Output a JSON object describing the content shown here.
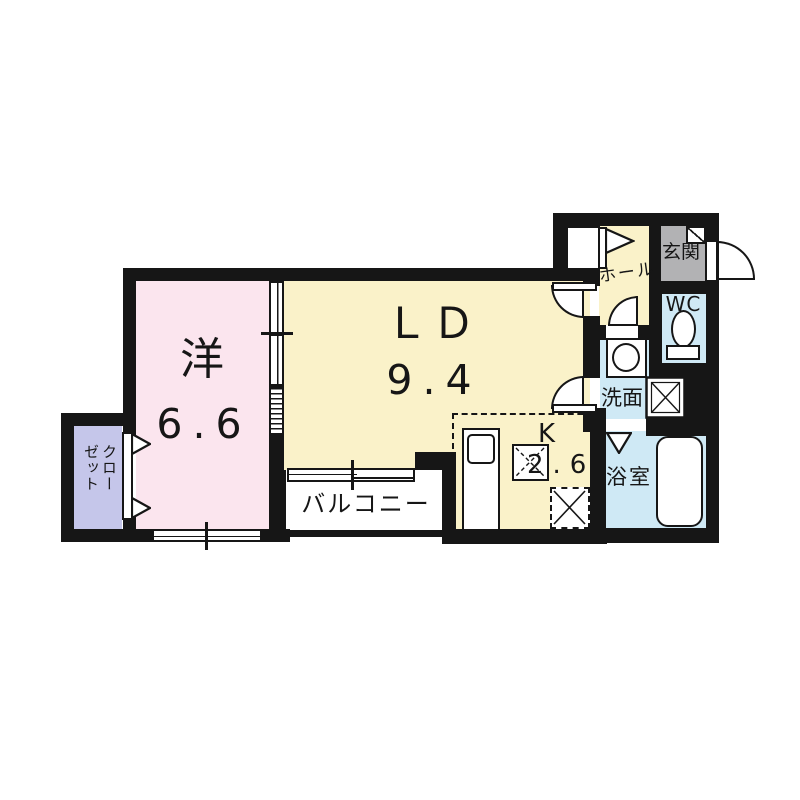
{
  "plan": {
    "type": "apartment-floorplan",
    "rooms": {
      "western": {
        "name": "洋",
        "area": "6.6"
      },
      "living_dining": {
        "name": "ＬＤ",
        "area": "9.4"
      },
      "kitchen": {
        "name": "K",
        "area": "2.6"
      },
      "balcony": {
        "name": "バルコニー"
      },
      "closet": {
        "name": "クローゼット"
      },
      "hall": {
        "name": "ホール"
      },
      "entrance": {
        "name": "玄関"
      },
      "toilet": {
        "name": "WC"
      },
      "washroom": {
        "name": "洗面"
      },
      "bathroom": {
        "name": "浴室"
      }
    },
    "colors": {
      "wall": "#161616",
      "western_room": "#fbe5ee",
      "living_dining": "#faf2c9",
      "wet_area": "#cfe9f5",
      "closet": "#c5c6ea",
      "entrance": "#b2b2b4",
      "background": "#ffffff"
    }
  }
}
